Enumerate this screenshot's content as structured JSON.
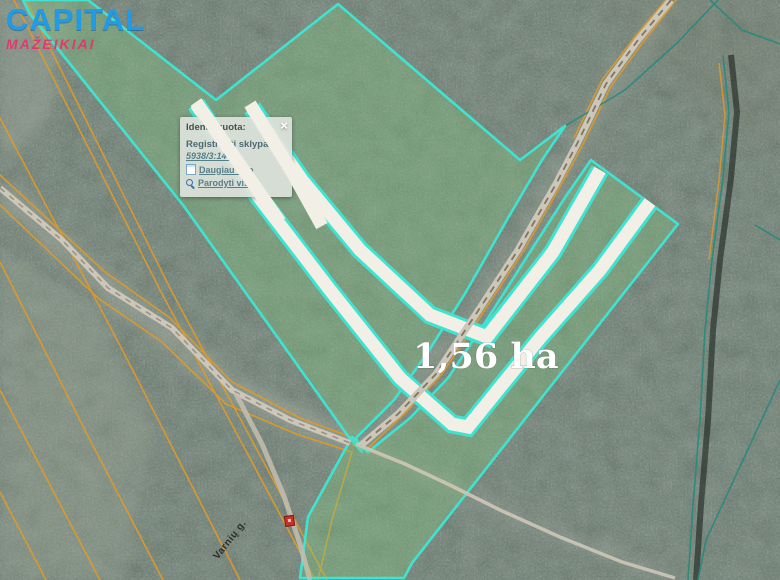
{
  "logo": {
    "title": "CAPITAL",
    "subtitle": "MAŽEIKIAI",
    "title_color": "#1E9BEA",
    "subtitle_color": "#E5346C"
  },
  "popup": {
    "title": "Identifikuota:",
    "close_label": "×",
    "section_label": "Registruoti sklypai:",
    "cadastral_link": "5938/3:144",
    "links": [
      {
        "icon": "info-page-icon",
        "label": "Daugiau info"
      },
      {
        "icon": "magnifier-icon",
        "label": "Parodyti visą"
      }
    ]
  },
  "map": {
    "area_label": "1,56 ha",
    "road_label": "Varnių g.",
    "marker": "red-building-marker",
    "colors": {
      "parcel_outline": "#3FE3D2",
      "parcel_fill": "#7FC57F",
      "divider_band": "#F2EFE6",
      "cadastral_line": "#E09A28",
      "forest_boundary": "#2A8A7C",
      "road": "#CDC7BA"
    }
  }
}
